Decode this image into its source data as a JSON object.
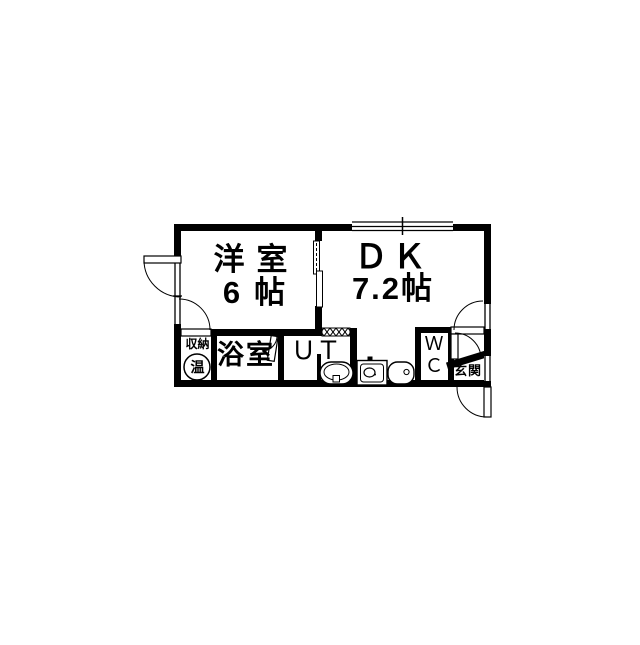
{
  "floorplan": {
    "background": "#ffffff",
    "wall_color": "#000000",
    "rooms": {
      "western_room": {
        "name": "洋室",
        "size": "6帖"
      },
      "dining_kitchen": {
        "name": "ＤＫ",
        "size": "7.2帖"
      },
      "bathroom": {
        "name": "浴室"
      },
      "utility": {
        "name": "ＵＴ"
      },
      "toilet": {
        "line1": "Ｗ",
        "line2": "Ｃ"
      },
      "storage": {
        "name": "収納"
      },
      "water_heater": {
        "label": "温"
      },
      "entrance": {
        "name": "玄関"
      }
    }
  }
}
